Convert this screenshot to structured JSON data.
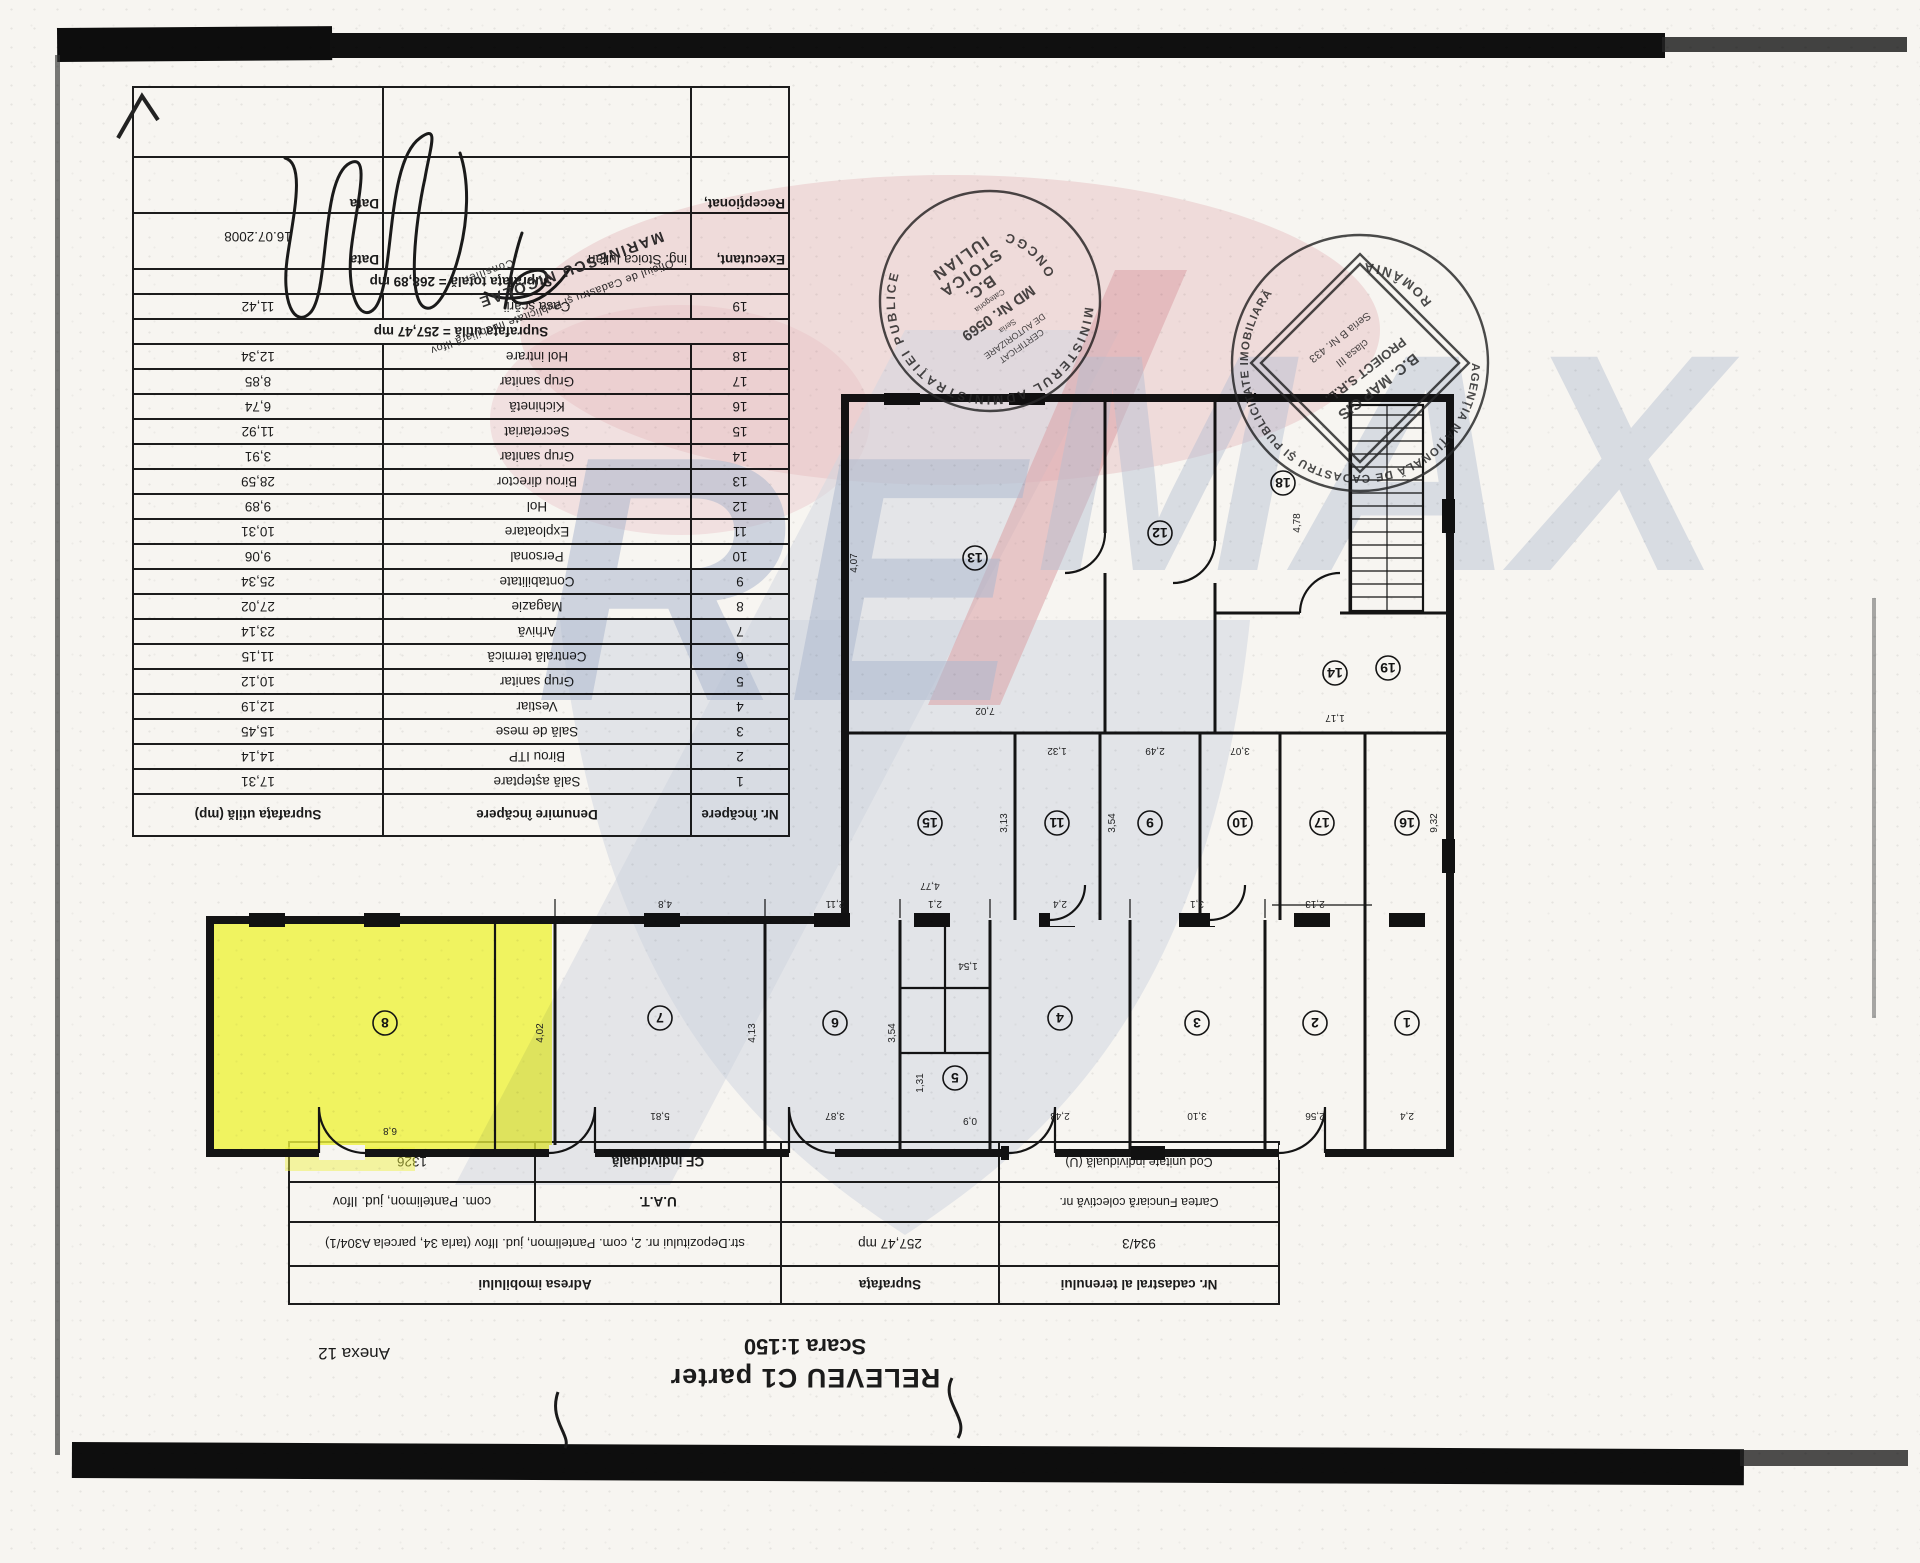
{
  "page": {
    "title_line1": "RELEVEU C1 parter",
    "title_line2": "Scara 1:150",
    "annex": "Anexa 12"
  },
  "info_table": {
    "col1_header": "Nr. cadastral al terenului",
    "col1_value": "934/3",
    "col1_row3": "Cartea Funciară colectivă nr.",
    "col1_row4": "Cod unitate individuală (U)",
    "col2_header": "Suprafaţa",
    "col2_value": "257,47 mp",
    "col3_header": "Adresa imobilului",
    "col3_value": "str.Depozitului nr. 2, com. Pantelimon, jud. Ilfov (tarla 34, parcela A304/1)",
    "uat_label": "U.A.T.",
    "uat_value": "com. Pantelimon, jud. Ilfov",
    "cf_label": "CF individuală",
    "cf_value": "1326"
  },
  "room_table": {
    "headers": [
      "Nr. încăpere",
      "Denumire încăpere",
      "Suprafaţa utilă (mp)"
    ],
    "rows": [
      {
        "nr": "1",
        "name": "Sală aşteptare",
        "area": "17,31"
      },
      {
        "nr": "2",
        "name": "Birou ITP",
        "area": "14,14"
      },
      {
        "nr": "3",
        "name": "Sală de mese",
        "area": "15,45"
      },
      {
        "nr": "4",
        "name": "Vestiar",
        "area": "12,19"
      },
      {
        "nr": "5",
        "name": "Grup sanitar",
        "area": "10,12"
      },
      {
        "nr": "6",
        "name": "Centrală termică",
        "area": "11,15"
      },
      {
        "nr": "7",
        "name": "Arhivă",
        "area": "23,14"
      },
      {
        "nr": "8",
        "name": "Magazie",
        "area": "27,02"
      },
      {
        "nr": "9",
        "name": "Contabilitate",
        "area": "25,34"
      },
      {
        "nr": "10",
        "name": "Personal",
        "area": "9,06"
      },
      {
        "nr": "11",
        "name": "Exploatare",
        "area": "10,31"
      },
      {
        "nr": "12",
        "name": "Hol",
        "area": "9,89"
      },
      {
        "nr": "13",
        "name": "Birou director",
        "area": "28,59"
      },
      {
        "nr": "14",
        "name": "Grup sanitar",
        "area": "3,91"
      },
      {
        "nr": "15",
        "name": "Secretariat",
        "area": "11,92"
      },
      {
        "nr": "16",
        "name": "Kichinetă",
        "area": "6,74"
      },
      {
        "nr": "17",
        "name": "Grup sanitar",
        "area": "8,85"
      },
      {
        "nr": "18",
        "name": "Hol intrare",
        "area": "12,34"
      },
      {
        "nr": "19",
        "name": "Casa scării",
        "area": "11,42"
      }
    ],
    "subtotal": "Suprafaţa utilă = 257,47 mp",
    "total": "Suprafaţa totală = 268,89 mp",
    "executant_label": "Executant,",
    "executant_name": "ing. Stoica Iulian",
    "executant_date_label": "Data",
    "executant_date": "16.07.2008",
    "receptionat_label": "Recepţionat,",
    "receptionat_date_label": "Data"
  },
  "stamps": {
    "round1": {
      "ring": "MINISTERUL  ADMINISTRAŢIEI  PUBLICE",
      "bottom": "ONCGC",
      "lines": [
        "CERTIFICAT",
        "DE AUTORIZARE",
        "Seria",
        "MD Nr. 0569",
        "Categoria",
        "B.C.",
        "STOICA",
        "IULIAN"
      ]
    },
    "round2": {
      "ring": "AGENŢIA NAŢIONALĂ DE CADASTRU ŞI PUBLICITATE IMOBILIARĂ",
      "bottom": "ROMÂNIA",
      "lines": [
        "B.C. MAP GIS",
        "PROIECT S.R.L.",
        "clasa III",
        "Seria B Nr. 433"
      ]
    },
    "office": {
      "line1": "Oficiul de Cadastru şi Publicitate Imobiliară Ilfov",
      "line2": "MARINESCU NICOLAE",
      "line3": "Consilier"
    }
  },
  "watermark": {
    "re": "RE",
    "max": "MAX"
  },
  "plan": {
    "highlight_color": "#edf23c",
    "rooms": [
      {
        "n": "1",
        "x": 48,
        "y": 150
      },
      {
        "n": "2",
        "x": 140,
        "y": 150
      },
      {
        "n": "3",
        "x": 258,
        "y": 150
      },
      {
        "n": "4",
        "x": 395,
        "y": 155
      },
      {
        "n": "5",
        "x": 500,
        "y": 95
      },
      {
        "n": "6",
        "x": 620,
        "y": 150
      },
      {
        "n": "7",
        "x": 795,
        "y": 155
      },
      {
        "n": "8",
        "x": 1070,
        "y": 150
      },
      {
        "n": "9",
        "x": 305,
        "y": 350
      },
      {
        "n": "10",
        "x": 215,
        "y": 350
      },
      {
        "n": "11",
        "x": 398,
        "y": 350
      },
      {
        "n": "12",
        "x": 295,
        "y": 640
      },
      {
        "n": "13",
        "x": 480,
        "y": 615
      },
      {
        "n": "14",
        "x": 120,
        "y": 500
      },
      {
        "n": "15",
        "x": 525,
        "y": 350
      },
      {
        "n": "16",
        "x": 48,
        "y": 350
      },
      {
        "n": "17",
        "x": 133,
        "y": 350
      },
      {
        "n": "18",
        "x": 172,
        "y": 690
      },
      {
        "n": "19",
        "x": 67,
        "y": 505
      }
    ],
    "dims": [
      {
        "t": "6,8",
        "x": 1065,
        "y": 45,
        "r": 0
      },
      {
        "t": "4,02",
        "x": 912,
        "y": 140,
        "r": 90
      },
      {
        "t": "5,81",
        "x": 795,
        "y": 60,
        "r": 0
      },
      {
        "t": "4,13",
        "x": 700,
        "y": 140,
        "r": 90
      },
      {
        "t": "3,87",
        "x": 620,
        "y": 60,
        "r": 0
      },
      {
        "t": "3,54",
        "x": 560,
        "y": 140,
        "r": 90
      },
      {
        "t": "2,43",
        "x": 395,
        "y": 60,
        "r": 0
      },
      {
        "t": "3,10",
        "x": 258,
        "y": 60,
        "r": 0
      },
      {
        "t": "2,56",
        "x": 140,
        "y": 60,
        "r": 0
      },
      {
        "t": "2,4",
        "x": 48,
        "y": 60,
        "r": 0
      },
      {
        "t": "0,9",
        "x": 485,
        "y": 55,
        "r": 0
      },
      {
        "t": "1,31",
        "x": 532,
        "y": 90,
        "r": 90
      },
      {
        "t": "1,54",
        "x": 487,
        "y": 210,
        "r": 0
      },
      {
        "t": "7,02",
        "x": 470,
        "y": 465,
        "r": 0
      },
      {
        "t": "4,07",
        "x": 598,
        "y": 610,
        "r": 90
      },
      {
        "t": "2,49",
        "x": 300,
        "y": 425,
        "r": 0
      },
      {
        "t": "3,54",
        "x": 340,
        "y": 350,
        "r": 90
      },
      {
        "t": "4,77",
        "x": 525,
        "y": 290,
        "r": 0
      },
      {
        "t": "3,13",
        "x": 448,
        "y": 350,
        "r": 90
      },
      {
        "t": "9,32",
        "x": 18,
        "y": 350,
        "r": 90
      },
      {
        "t": "1,17",
        "x": 120,
        "y": 458,
        "r": 0
      },
      {
        "t": "4,78",
        "x": 155,
        "y": 650,
        "r": 90
      },
      {
        "t": "1,32",
        "x": 398,
        "y": 425,
        "r": 0
      },
      {
        "t": "3,07",
        "x": 215,
        "y": 425,
        "r": 0
      },
      {
        "t": "2,13",
        "x": 140,
        "y": 272,
        "r": 0
      },
      {
        "t": "3,1",
        "x": 258,
        "y": 272,
        "r": 0
      },
      {
        "t": "2,4",
        "x": 395,
        "y": 272,
        "r": 0
      },
      {
        "t": "2,1",
        "x": 520,
        "y": 272,
        "r": 0
      },
      {
        "t": "2,11",
        "x": 620,
        "y": 272,
        "r": 0
      },
      {
        "t": "4,8",
        "x": 790,
        "y": 272,
        "r": 0
      }
    ]
  },
  "colors": {
    "paper": "#f7f5f1",
    "ink": "#1c1c1c",
    "highlight": "#edf23c",
    "watermark_blue": "#b3c0da",
    "watermark_pink": "#efc9cf",
    "stamp_ink": "#2b2b2b"
  }
}
